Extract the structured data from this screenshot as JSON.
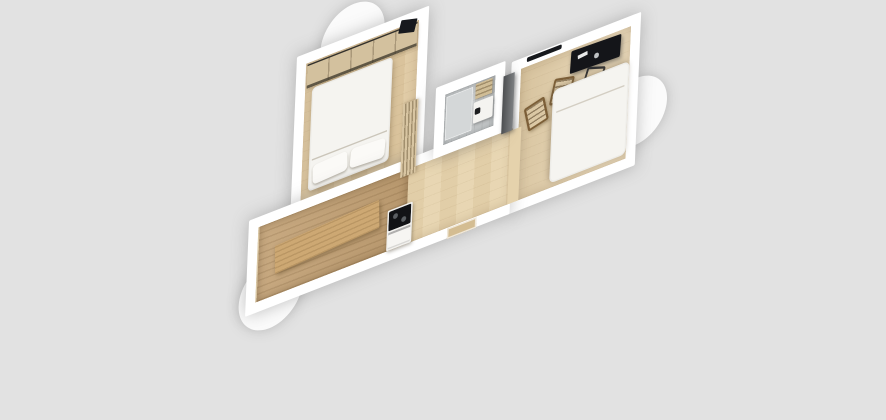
{
  "scene": {
    "description": "3D top-down perspective render of a small apartment floor plan on a plain grey backdrop",
    "background_color": "#e2e2e2",
    "wall_color": "#ffffff",
    "bay_window_count": 3
  },
  "palette": {
    "background": "#e2e2e2",
    "wall": "#ffffff",
    "bay": "#fbfbfb",
    "floor_corridor": "#e7d4ae",
    "floor_bedroom": "#dfc9a2",
    "floor_living": "#e2cda6",
    "floor_kitchen_dark": "#c2a073",
    "junction_floor": "#e5d2ac",
    "bench_wood": "#cda873",
    "wardrobe_wood": "#d3c19e",
    "curtain": "#d8c5a2",
    "bathroom_tile": "#c6c9ca",
    "shower_tile": "#d4d7d8",
    "towel_wood": "#d0bd96",
    "sink_white": "#f4f3f0",
    "faucet_black": "#1c1d1f",
    "panel_dark": "#66696c",
    "desk_black": "#141519",
    "tv_black": "#17191d",
    "cooktop_black": "#121316",
    "cabinet_white": "#f1f0ed",
    "oven_white": "#f6f5f2",
    "linen_white": "#f5f4f0",
    "pillow_white": "#fbfaf7",
    "door_wood": "#d4bd92"
  },
  "rooms": [
    {
      "id": "bedroom",
      "position": "upper-left",
      "bay_window": true,
      "furniture": [
        "wardrobe",
        "double-bed",
        "pillow",
        "pillow",
        "curtain-divider",
        "tv"
      ]
    },
    {
      "id": "bathroom",
      "position": "center",
      "bay_window": false,
      "furniture": [
        "shower-area",
        "sink-with-faucet",
        "towel-shelf"
      ]
    },
    {
      "id": "kitchen-hallway",
      "position": "lower-left-strip",
      "bay_window": true,
      "furniture": [
        "dark-wood-floor-area",
        "kitchen-bench",
        "cooktop-with-oven",
        "entrance-door"
      ]
    },
    {
      "id": "living-room",
      "position": "right",
      "bay_window": true,
      "furniture": [
        "window",
        "black-desk",
        "desk-chair",
        "wooden-chair",
        "wooden-chair",
        "white-double-bed",
        "dark-wardrobe-panel"
      ]
    }
  ]
}
